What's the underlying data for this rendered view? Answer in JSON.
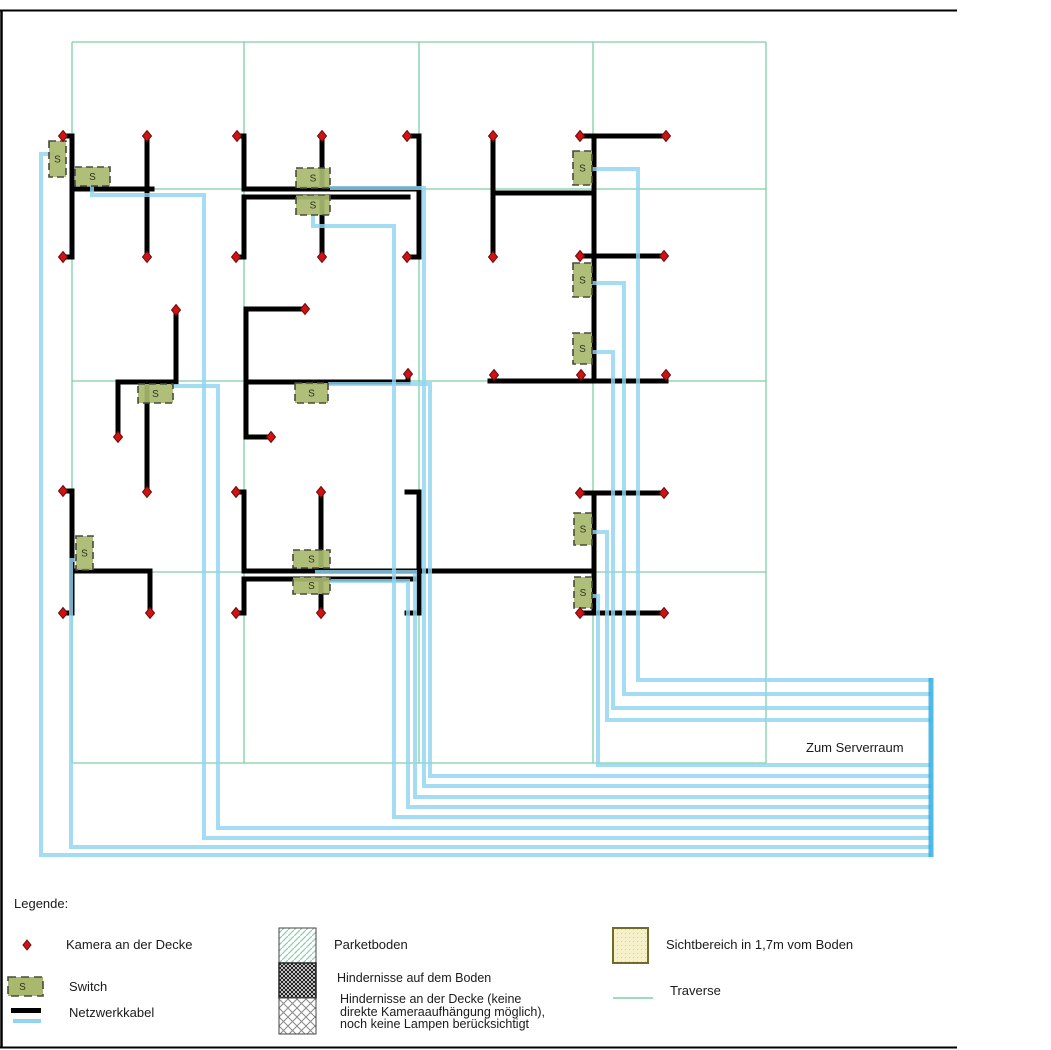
{
  "colors": {
    "grid_green": "#7dcfa3",
    "cable_black": "#000000",
    "cable_blue": "#90d4f0",
    "trunk_blue": "#35aee3",
    "camera_red": "#cf1315",
    "camera_border": "#6d0b0b",
    "switch_fill": "#a8b96e",
    "switch_border": "#4a4a3c",
    "sicht_fill": "#f5f0c9",
    "sicht_border": "#6f6b28",
    "frame_black": "#000000"
  },
  "frame": {
    "left": {
      "x": 1.5,
      "y1": 10,
      "y2": 1048
    },
    "top": {
      "y": 10.5,
      "x1": 0,
      "x2": 957
    },
    "bottom": {
      "y": 1047.5,
      "x1": 0,
      "x2": 957
    }
  },
  "diagram": {
    "grid": {
      "v": [
        72,
        244,
        419,
        593,
        766
      ],
      "h": [
        42,
        189,
        381,
        572,
        763
      ],
      "x1": 72,
      "x2": 766,
      "y1": 42,
      "y2": 763
    },
    "cameras": [
      [
        63,
        136
      ],
      [
        147,
        136
      ],
      [
        237,
        136
      ],
      [
        322,
        136
      ],
      [
        407,
        136
      ],
      [
        493,
        136
      ],
      [
        580,
        136
      ],
      [
        666,
        136
      ],
      [
        63,
        257
      ],
      [
        147,
        257
      ],
      [
        236,
        257
      ],
      [
        322,
        257
      ],
      [
        407,
        257
      ],
      [
        493,
        257
      ],
      [
        580,
        256
      ],
      [
        664,
        256
      ],
      [
        176,
        310
      ],
      [
        305,
        309
      ],
      [
        118,
        437
      ],
      [
        271,
        437
      ],
      [
        147,
        492
      ],
      [
        408,
        374
      ],
      [
        494,
        375
      ],
      [
        581,
        375
      ],
      [
        666,
        375
      ],
      [
        63,
        491
      ],
      [
        236,
        492
      ],
      [
        321,
        492
      ],
      [
        580,
        493
      ],
      [
        664,
        493
      ],
      [
        63,
        613
      ],
      [
        150,
        613
      ],
      [
        236,
        613
      ],
      [
        321,
        613
      ],
      [
        580,
        613
      ],
      [
        664,
        613
      ]
    ],
    "switches": [
      {
        "x": 49,
        "y": 141,
        "w": 17,
        "h": 36,
        "label": "S"
      },
      {
        "x": 75,
        "y": 167,
        "w": 35,
        "h": 19,
        "label": "S"
      },
      {
        "x": 296,
        "y": 168,
        "w": 34,
        "h": 20,
        "label": "S"
      },
      {
        "x": 296,
        "y": 195,
        "w": 34,
        "h": 20,
        "label": "S"
      },
      {
        "x": 573,
        "y": 151,
        "w": 19,
        "h": 34,
        "label": "S"
      },
      {
        "x": 573,
        "y": 263,
        "w": 19,
        "h": 34,
        "label": "S"
      },
      {
        "x": 573,
        "y": 333,
        "w": 19,
        "h": 31,
        "label": "S"
      },
      {
        "x": 138,
        "y": 384,
        "w": 35,
        "h": 19,
        "label": "S"
      },
      {
        "x": 295,
        "y": 383,
        "w": 33,
        "h": 20,
        "label": "S"
      },
      {
        "x": 76,
        "y": 536,
        "w": 17,
        "h": 34,
        "label": "S"
      },
      {
        "x": 293,
        "y": 550,
        "w": 37,
        "h": 18,
        "label": "S"
      },
      {
        "x": 293,
        "y": 577,
        "w": 37,
        "h": 17,
        "label": "S"
      },
      {
        "x": 574,
        "y": 513,
        "w": 18,
        "h": 32,
        "label": "S"
      },
      {
        "x": 574,
        "y": 577,
        "w": 18,
        "h": 31,
        "label": "S"
      }
    ],
    "black_cables": [
      [
        [
          63,
          136
        ],
        [
          72,
          136
        ],
        [
          72,
          257
        ],
        [
          63,
          257
        ]
      ],
      [
        [
          147,
          136
        ],
        [
          147,
          257
        ]
      ],
      [
        [
          73,
          189
        ],
        [
          152,
          189
        ]
      ],
      [
        [
          237,
          136
        ],
        [
          244,
          136
        ],
        [
          244,
          189
        ]
      ],
      [
        [
          244,
          197
        ],
        [
          244,
          257
        ],
        [
          236,
          257
        ]
      ],
      [
        [
          322,
          136
        ],
        [
          322,
          189
        ]
      ],
      [
        [
          322,
          197
        ],
        [
          322,
          257
        ]
      ],
      [
        [
          244,
          189
        ],
        [
          419,
          189
        ]
      ],
      [
        [
          244,
          197
        ],
        [
          408,
          197
        ]
      ],
      [
        [
          407,
          136
        ],
        [
          419,
          136
        ],
        [
          419,
          257
        ],
        [
          407,
          257
        ]
      ],
      [
        [
          493,
          136
        ],
        [
          493,
          257
        ]
      ],
      [
        [
          580,
          136
        ],
        [
          594,
          136
        ],
        [
          594,
          381
        ]
      ],
      [
        [
          594,
          136
        ],
        [
          666,
          136
        ]
      ],
      [
        [
          493,
          193
        ],
        [
          594,
          193
        ]
      ],
      [
        [
          580,
          256
        ],
        [
          664,
          256
        ]
      ],
      [
        [
          176,
          310
        ],
        [
          176,
          382
        ]
      ],
      [
        [
          118,
          382
        ],
        [
          176,
          382
        ]
      ],
      [
        [
          118,
          382
        ],
        [
          118,
          437
        ]
      ],
      [
        [
          147,
          384
        ],
        [
          147,
          491
        ]
      ],
      [
        [
          246,
          309
        ],
        [
          246,
          437
        ]
      ],
      [
        [
          246,
          309
        ],
        [
          301,
          309
        ]
      ],
      [
        [
          246,
          437
        ],
        [
          267,
          437
        ]
      ],
      [
        [
          246,
          382
        ],
        [
          404,
          382
        ]
      ],
      [
        [
          408,
          377
        ],
        [
          408,
          382
        ]
      ],
      [
        [
          490,
          381
        ],
        [
          666,
          381
        ]
      ],
      [
        [
          494,
          377
        ],
        [
          494,
          381
        ]
      ],
      [
        [
          581,
          377
        ],
        [
          581,
          381
        ]
      ],
      [
        [
          666,
          377
        ],
        [
          666,
          381
        ]
      ],
      [
        [
          63,
          491
        ],
        [
          72,
          491
        ],
        [
          72,
          613
        ],
        [
          63,
          613
        ]
      ],
      [
        [
          73,
          571
        ],
        [
          150,
          571
        ]
      ],
      [
        [
          150,
          571
        ],
        [
          150,
          613
        ]
      ],
      [
        [
          236,
          492
        ],
        [
          244,
          492
        ],
        [
          244,
          571
        ]
      ],
      [
        [
          244,
          579
        ],
        [
          244,
          613
        ],
        [
          236,
          613
        ]
      ],
      [
        [
          321,
          492
        ],
        [
          321,
          571
        ]
      ],
      [
        [
          321,
          579
        ],
        [
          321,
          613
        ]
      ],
      [
        [
          244,
          571
        ],
        [
          594,
          571
        ]
      ],
      [
        [
          244,
          579
        ],
        [
          419,
          579
        ]
      ],
      [
        [
          594,
          493
        ],
        [
          594,
          613
        ]
      ],
      [
        [
          580,
          493
        ],
        [
          664,
          493
        ]
      ],
      [
        [
          580,
          613
        ],
        [
          664,
          613
        ]
      ],
      [
        [
          407,
          492
        ],
        [
          419,
          492
        ],
        [
          419,
          613
        ],
        [
          407,
          613
        ]
      ]
    ],
    "blue_cables": [
      [
        [
          55,
          154
        ],
        [
          41,
          154
        ],
        [
          41,
          855
        ],
        [
          931,
          855
        ]
      ],
      [
        [
          92,
          186
        ],
        [
          92,
          195
        ],
        [
          204,
          195
        ],
        [
          204,
          838
        ],
        [
          931,
          838
        ]
      ],
      [
        [
          330,
          188
        ],
        [
          424,
          188
        ],
        [
          424,
          786
        ],
        [
          931,
          786
        ]
      ],
      [
        [
          313,
          215
        ],
        [
          313,
          226
        ],
        [
          394,
          226
        ],
        [
          394,
          817
        ],
        [
          931,
          817
        ]
      ],
      [
        [
          592,
          169
        ],
        [
          638,
          169
        ],
        [
          638,
          680
        ],
        [
          931,
          680
        ]
      ],
      [
        [
          592,
          283
        ],
        [
          624,
          283
        ],
        [
          624,
          694
        ],
        [
          931,
          694
        ]
      ],
      [
        [
          592,
          352
        ],
        [
          613,
          352
        ],
        [
          613,
          708
        ],
        [
          931,
          708
        ]
      ],
      [
        [
          173,
          386
        ],
        [
          218,
          386
        ],
        [
          218,
          828
        ],
        [
          931,
          828
        ]
      ],
      [
        [
          328,
          384
        ],
        [
          430,
          384
        ],
        [
          430,
          776
        ],
        [
          931,
          776
        ]
      ],
      [
        [
          76,
          560
        ],
        [
          71,
          560
        ],
        [
          71,
          847
        ],
        [
          931,
          847
        ]
      ],
      [
        [
          315,
          572
        ],
        [
          415,
          572
        ],
        [
          415,
          797
        ],
        [
          931,
          797
        ]
      ],
      [
        [
          330,
          581
        ],
        [
          408,
          581
        ],
        [
          408,
          807
        ],
        [
          931,
          807
        ]
      ],
      [
        [
          592,
          532
        ],
        [
          607,
          532
        ],
        [
          607,
          720
        ],
        [
          931,
          720
        ]
      ],
      [
        [
          592,
          596
        ],
        [
          598,
          596
        ],
        [
          598,
          765
        ],
        [
          931,
          765
        ]
      ]
    ],
    "trunk": {
      "x": 931,
      "y1": 678,
      "y2": 857
    },
    "server_label": {
      "text": "Zum Serverraum"
    }
  },
  "legend": {
    "title": "Legende:",
    "items": [
      {
        "key": "kamera",
        "label": "Kamera an der Decke"
      },
      {
        "key": "switch",
        "label": "Switch"
      },
      {
        "key": "netzwerkkabel",
        "label": "Netzwerkkabel"
      },
      {
        "key": "parkettboden",
        "label": "Parketboden"
      },
      {
        "key": "hindernisse-boden",
        "label": "Hindernisse auf dem Boden"
      },
      {
        "key": "hindernisse-decke",
        "lines": [
          "Hindernisse an der Decke (keine",
          "direkte Kameraaufhängung möglich),",
          "noch keine Lampen berücksichtigt"
        ]
      },
      {
        "key": "sichtbereich",
        "label": "Sichtbereich in 1,7m vom Boden"
      },
      {
        "key": "traverse",
        "label": "Traverse"
      }
    ],
    "symbols": {
      "camera": {
        "x": 27,
        "y": 945
      },
      "switch_box": {
        "x": 8,
        "y": 977,
        "w": 35,
        "h": 19
      },
      "black_bar": {
        "x": 11,
        "y": 1008,
        "w": 30,
        "h": 5
      },
      "blue_bar": {
        "x": 13,
        "y": 1019,
        "w": 28,
        "h": 4
      },
      "parkett_box": {
        "x": 279,
        "y": 928,
        "w": 37,
        "h": 35
      },
      "boden_box": {
        "x": 279,
        "y": 963,
        "w": 37,
        "h": 35
      },
      "decke_box": {
        "x": 279,
        "y": 998,
        "w": 37,
        "h": 36
      },
      "sicht_box": {
        "x": 613,
        "y": 928,
        "w": 35,
        "h": 35
      },
      "traverse_line": {
        "x1": 613,
        "y": 998,
        "x2": 653
      }
    }
  }
}
